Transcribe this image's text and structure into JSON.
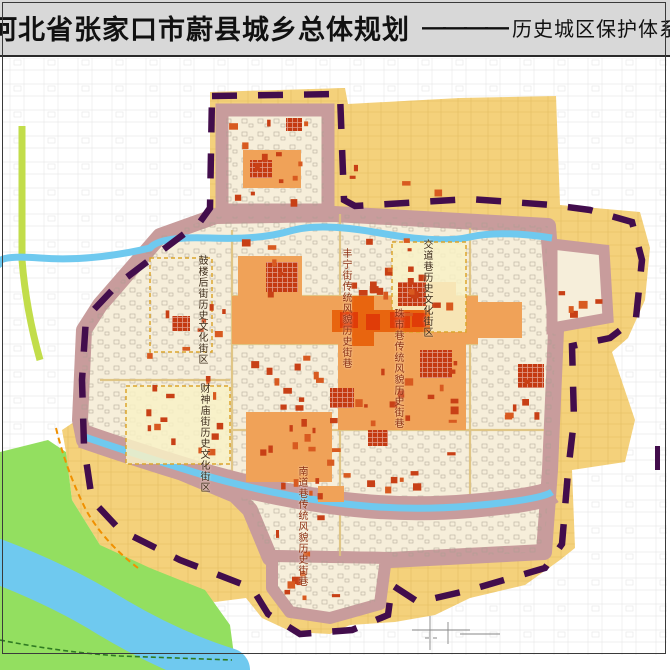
{
  "title": {
    "main": "河北省张家口市蔚县城乡总体规划",
    "separator": "————",
    "sub": "历史城区保护体系规划图"
  },
  "map_labels": [
    {
      "text": "鼓楼后街历史文化街区",
      "kind": "historic-cultural-district"
    },
    {
      "text": "丰宁街传统风貌历史街巷",
      "kind": "traditional-historic-street"
    },
    {
      "text": "交道巷历史文化街区",
      "kind": "historic-cultural-district"
    },
    {
      "text": "珠市巷传统风貌历史街巷",
      "kind": "traditional-historic-street"
    },
    {
      "text": "财神庙街历史文化街区",
      "kind": "historic-cultural-district"
    },
    {
      "text": "南道巷传统风貌历史街巷",
      "kind": "traditional-historic-street"
    }
  ],
  "colors": {
    "title_bar_background": "#d8d8d8",
    "historic_area_yellow": "#f4d17b",
    "city_wall_mauve": "#c89c9c",
    "old_town_cream": "#f6eeda",
    "traditional_zone_orange": "#f0a258",
    "commercial_core_orange": "#e8650f",
    "protected_building_red": "#c84016",
    "river_blue": "#6fc9ef",
    "park_green": "#93df60",
    "boundary_purple": "#420d4c",
    "street_zone_pale": "#f8f1c6",
    "zone_border_yellow": "#dca62e"
  }
}
